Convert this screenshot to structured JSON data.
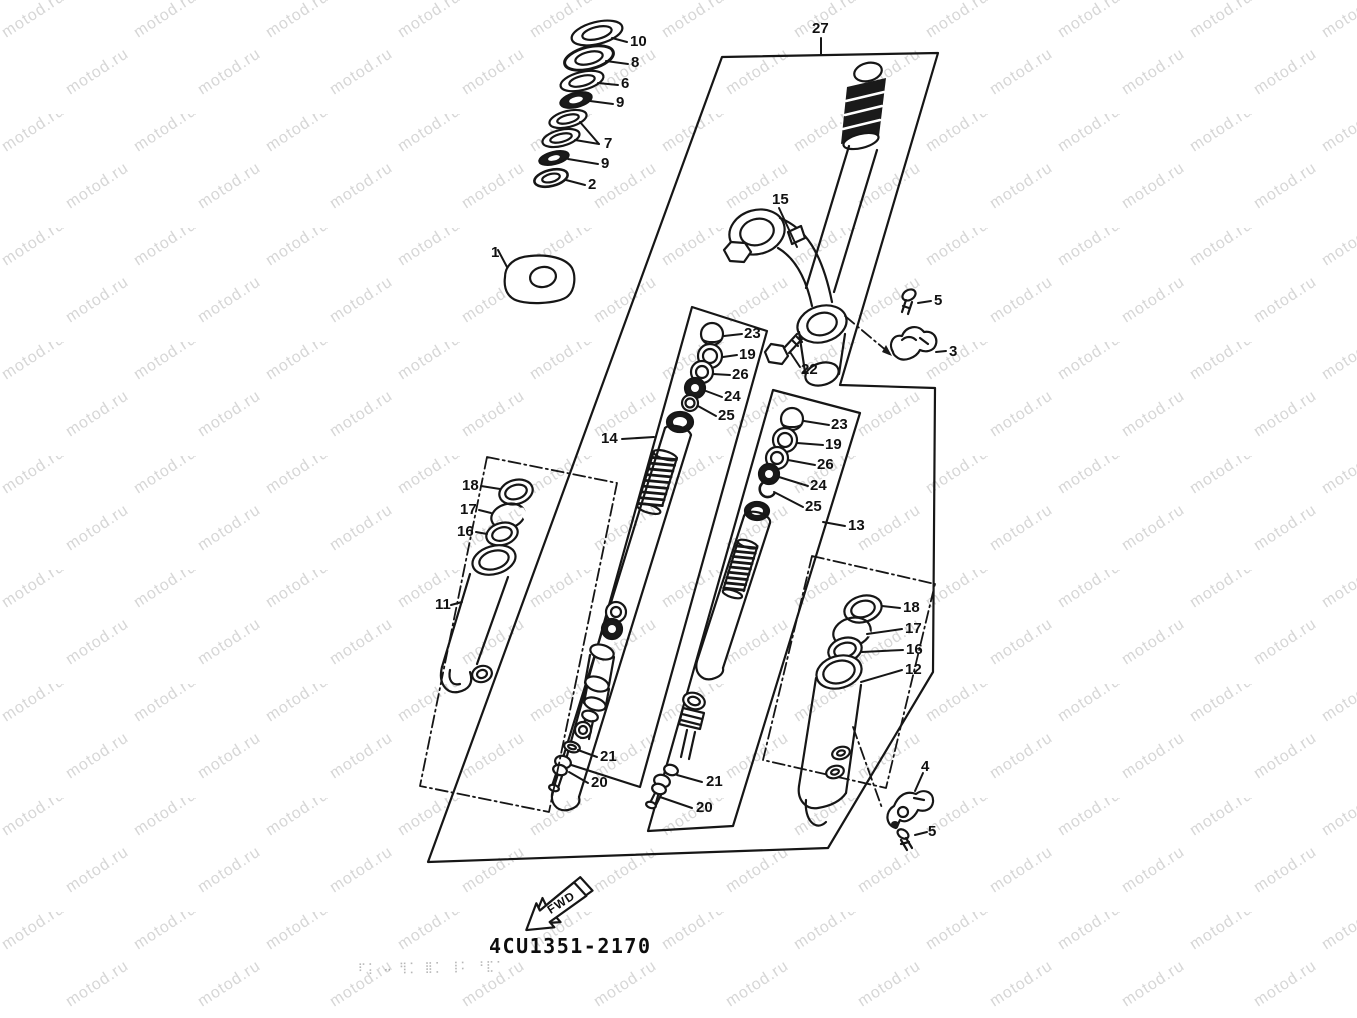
{
  "watermark": {
    "text": "motod.ru",
    "color": "#d6d6d6"
  },
  "drawing": {
    "part_number": "4CU1351-2170",
    "fwd_label": "FWD",
    "faint_stamp": "⠏⡅ ⠤ ⢻⡁ ⣿⡁ ⢸⠅ ⠘⣏⠁",
    "ink_color": "#161616",
    "description": "Exploded parts diagram of a motorcycle front fork / steering stem assembly"
  },
  "callouts": [
    {
      "label": "10",
      "x": 630,
      "y": 46
    },
    {
      "label": "8",
      "x": 631,
      "y": 67
    },
    {
      "label": "6",
      "x": 621,
      "y": 88
    },
    {
      "label": "9",
      "x": 616,
      "y": 107
    },
    {
      "label": "7",
      "x": 604,
      "y": 148
    },
    {
      "label": "9",
      "x": 601,
      "y": 168
    },
    {
      "label": "2",
      "x": 588,
      "y": 189
    },
    {
      "label": "1",
      "x": 491,
      "y": 257
    },
    {
      "label": "27",
      "x": 812,
      "y": 33
    },
    {
      "label": "15",
      "x": 772,
      "y": 204
    },
    {
      "label": "5",
      "x": 934,
      "y": 305
    },
    {
      "label": "3",
      "x": 949,
      "y": 356
    },
    {
      "label": "22",
      "x": 801,
      "y": 374
    },
    {
      "label": "23",
      "x": 744,
      "y": 338
    },
    {
      "label": "19",
      "x": 739,
      "y": 359
    },
    {
      "label": "26",
      "x": 732,
      "y": 379
    },
    {
      "label": "24",
      "x": 724,
      "y": 401
    },
    {
      "label": "25",
      "x": 718,
      "y": 420
    },
    {
      "label": "14",
      "x": 601,
      "y": 443
    },
    {
      "label": "23",
      "x": 831,
      "y": 429
    },
    {
      "label": "19",
      "x": 825,
      "y": 449
    },
    {
      "label": "26",
      "x": 817,
      "y": 469
    },
    {
      "label": "24",
      "x": 810,
      "y": 490
    },
    {
      "label": "25",
      "x": 805,
      "y": 511
    },
    {
      "label": "13",
      "x": 848,
      "y": 530
    },
    {
      "label": "18",
      "x": 462,
      "y": 490
    },
    {
      "label": "17",
      "x": 460,
      "y": 514
    },
    {
      "label": "16",
      "x": 457,
      "y": 536
    },
    {
      "label": "11",
      "x": 435,
      "y": 609
    },
    {
      "label": "18",
      "x": 903,
      "y": 612
    },
    {
      "label": "17",
      "x": 905,
      "y": 633
    },
    {
      "label": "16",
      "x": 906,
      "y": 654
    },
    {
      "label": "12",
      "x": 905,
      "y": 674
    },
    {
      "label": "21",
      "x": 600,
      "y": 761
    },
    {
      "label": "20",
      "x": 591,
      "y": 787
    },
    {
      "label": "21",
      "x": 706,
      "y": 786
    },
    {
      "label": "20",
      "x": 696,
      "y": 812
    },
    {
      "label": "4",
      "x": 921,
      "y": 771
    },
    {
      "label": "5",
      "x": 928,
      "y": 836
    }
  ]
}
